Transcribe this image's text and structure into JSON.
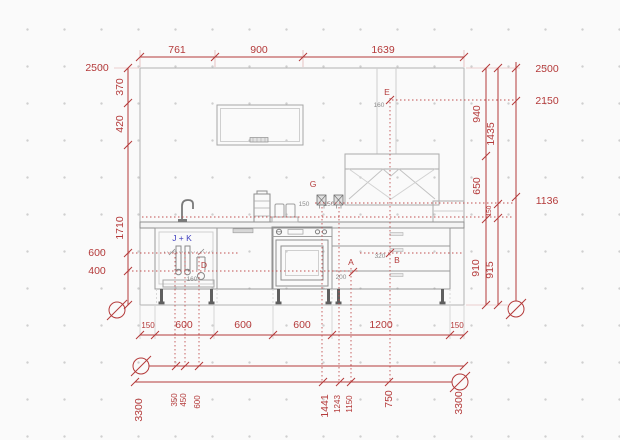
{
  "colors": {
    "dimension_red": "#b43a3a",
    "drawing_gray": "#9a9a9a",
    "label_blue": "#4040bf",
    "small_text_gray": "#8c8c8c"
  },
  "dims": {
    "top": [
      "761",
      "900",
      "1639"
    ],
    "overall_left": "2500",
    "left_chain": [
      "370",
      "420",
      "1710"
    ],
    "left_heights": [
      "600",
      "400"
    ],
    "right_inner": [
      "940",
      "650",
      "910"
    ],
    "right_mid": [
      "1435",
      "150",
      "915"
    ],
    "right_levels": [
      "2500",
      "2150",
      "1136"
    ],
    "base": [
      "150",
      "600",
      "600",
      "600",
      "1200",
      "150"
    ],
    "axis_top": [
      "3300",
      "350",
      "450",
      "600"
    ],
    "axis_bottom": [
      "1441",
      "1243",
      "1150",
      "750",
      "3300"
    ]
  },
  "points": {
    "e": {
      "label": "E",
      "dim": "160"
    },
    "g": {
      "label": "G",
      "dim_left": "150",
      "dim_right": "150"
    },
    "jk": {
      "label": "J + K"
    },
    "d": {
      "label": "D",
      "dim": "160"
    },
    "a": {
      "label": "A",
      "dim": "200"
    },
    "b": {
      "label": "B",
      "dim": "320"
    }
  }
}
